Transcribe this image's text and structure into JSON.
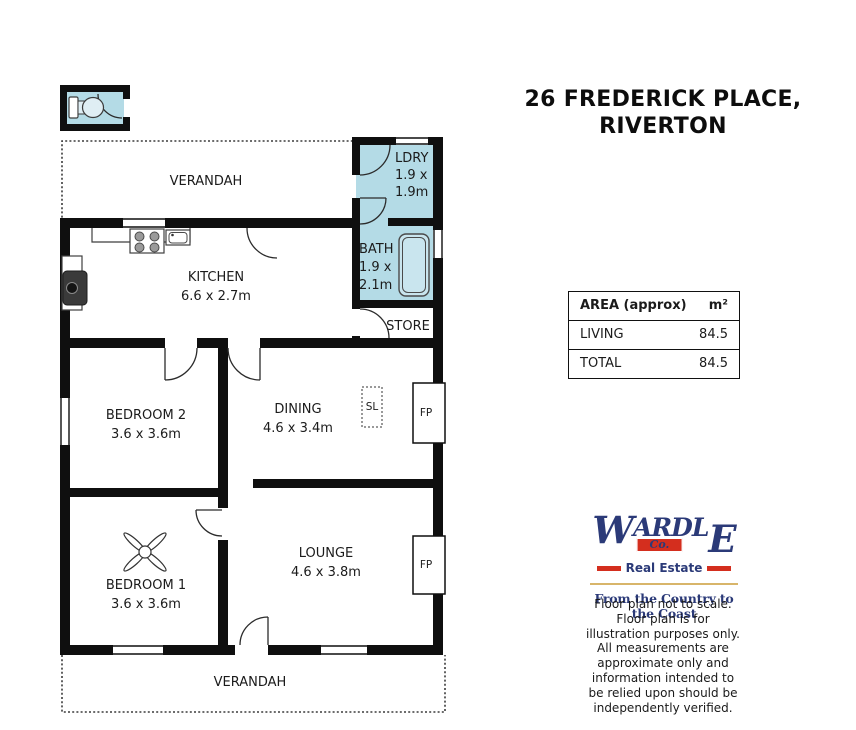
{
  "title": {
    "line1": "26 FREDERICK PLACE,",
    "line2": "RIVERTON"
  },
  "floorplan": {
    "verandah_top": "VERANDAH",
    "verandah_bottom": "VERANDAH",
    "wet_area_color": "#b4dbe6",
    "rooms": {
      "kitchen": {
        "name": "KITCHEN",
        "dims": "6.6 x 2.7m"
      },
      "bedroom2": {
        "name": "BEDROOM 2",
        "dims": "3.6 x 3.6m"
      },
      "dining": {
        "name": "DINING",
        "dims": "4.6 x 3.4m"
      },
      "bedroom1": {
        "name": "BEDROOM 1",
        "dims": "3.6 x 3.6m"
      },
      "lounge": {
        "name": "LOUNGE",
        "dims": "4.6 x 3.8m"
      },
      "laundry": {
        "name": "LDRY",
        "dims1": "1.9 x",
        "dims2": "1.9m"
      },
      "bath": {
        "name": "BATH",
        "dims1": "1.9 x",
        "dims2": "2.1m"
      },
      "store": {
        "name": "STORE"
      }
    },
    "annotations": {
      "skylight": "SL",
      "fireplace": "FP"
    }
  },
  "area_table": {
    "header": {
      "label": "AREA (approx)",
      "unit": "m²"
    },
    "rows": [
      {
        "label": "LIVING",
        "value": "84.5"
      },
      {
        "label": "TOTAL",
        "value": "84.5"
      }
    ]
  },
  "logo": {
    "brand": "WARDLE",
    "co": "Co.",
    "division": "Real Estate",
    "tagline": "From the Country to the Coast",
    "colors": {
      "navy": "#2b3a78",
      "red": "#d42e1e",
      "gold": "#d8b56a"
    }
  },
  "disclaimer": "Floor plan not to scale.\nFloor plan is for\nillustration purposes only.\nAll measurements are\napproximate only and\ninformation intended to\nbe relied upon should be\nindependently verified."
}
